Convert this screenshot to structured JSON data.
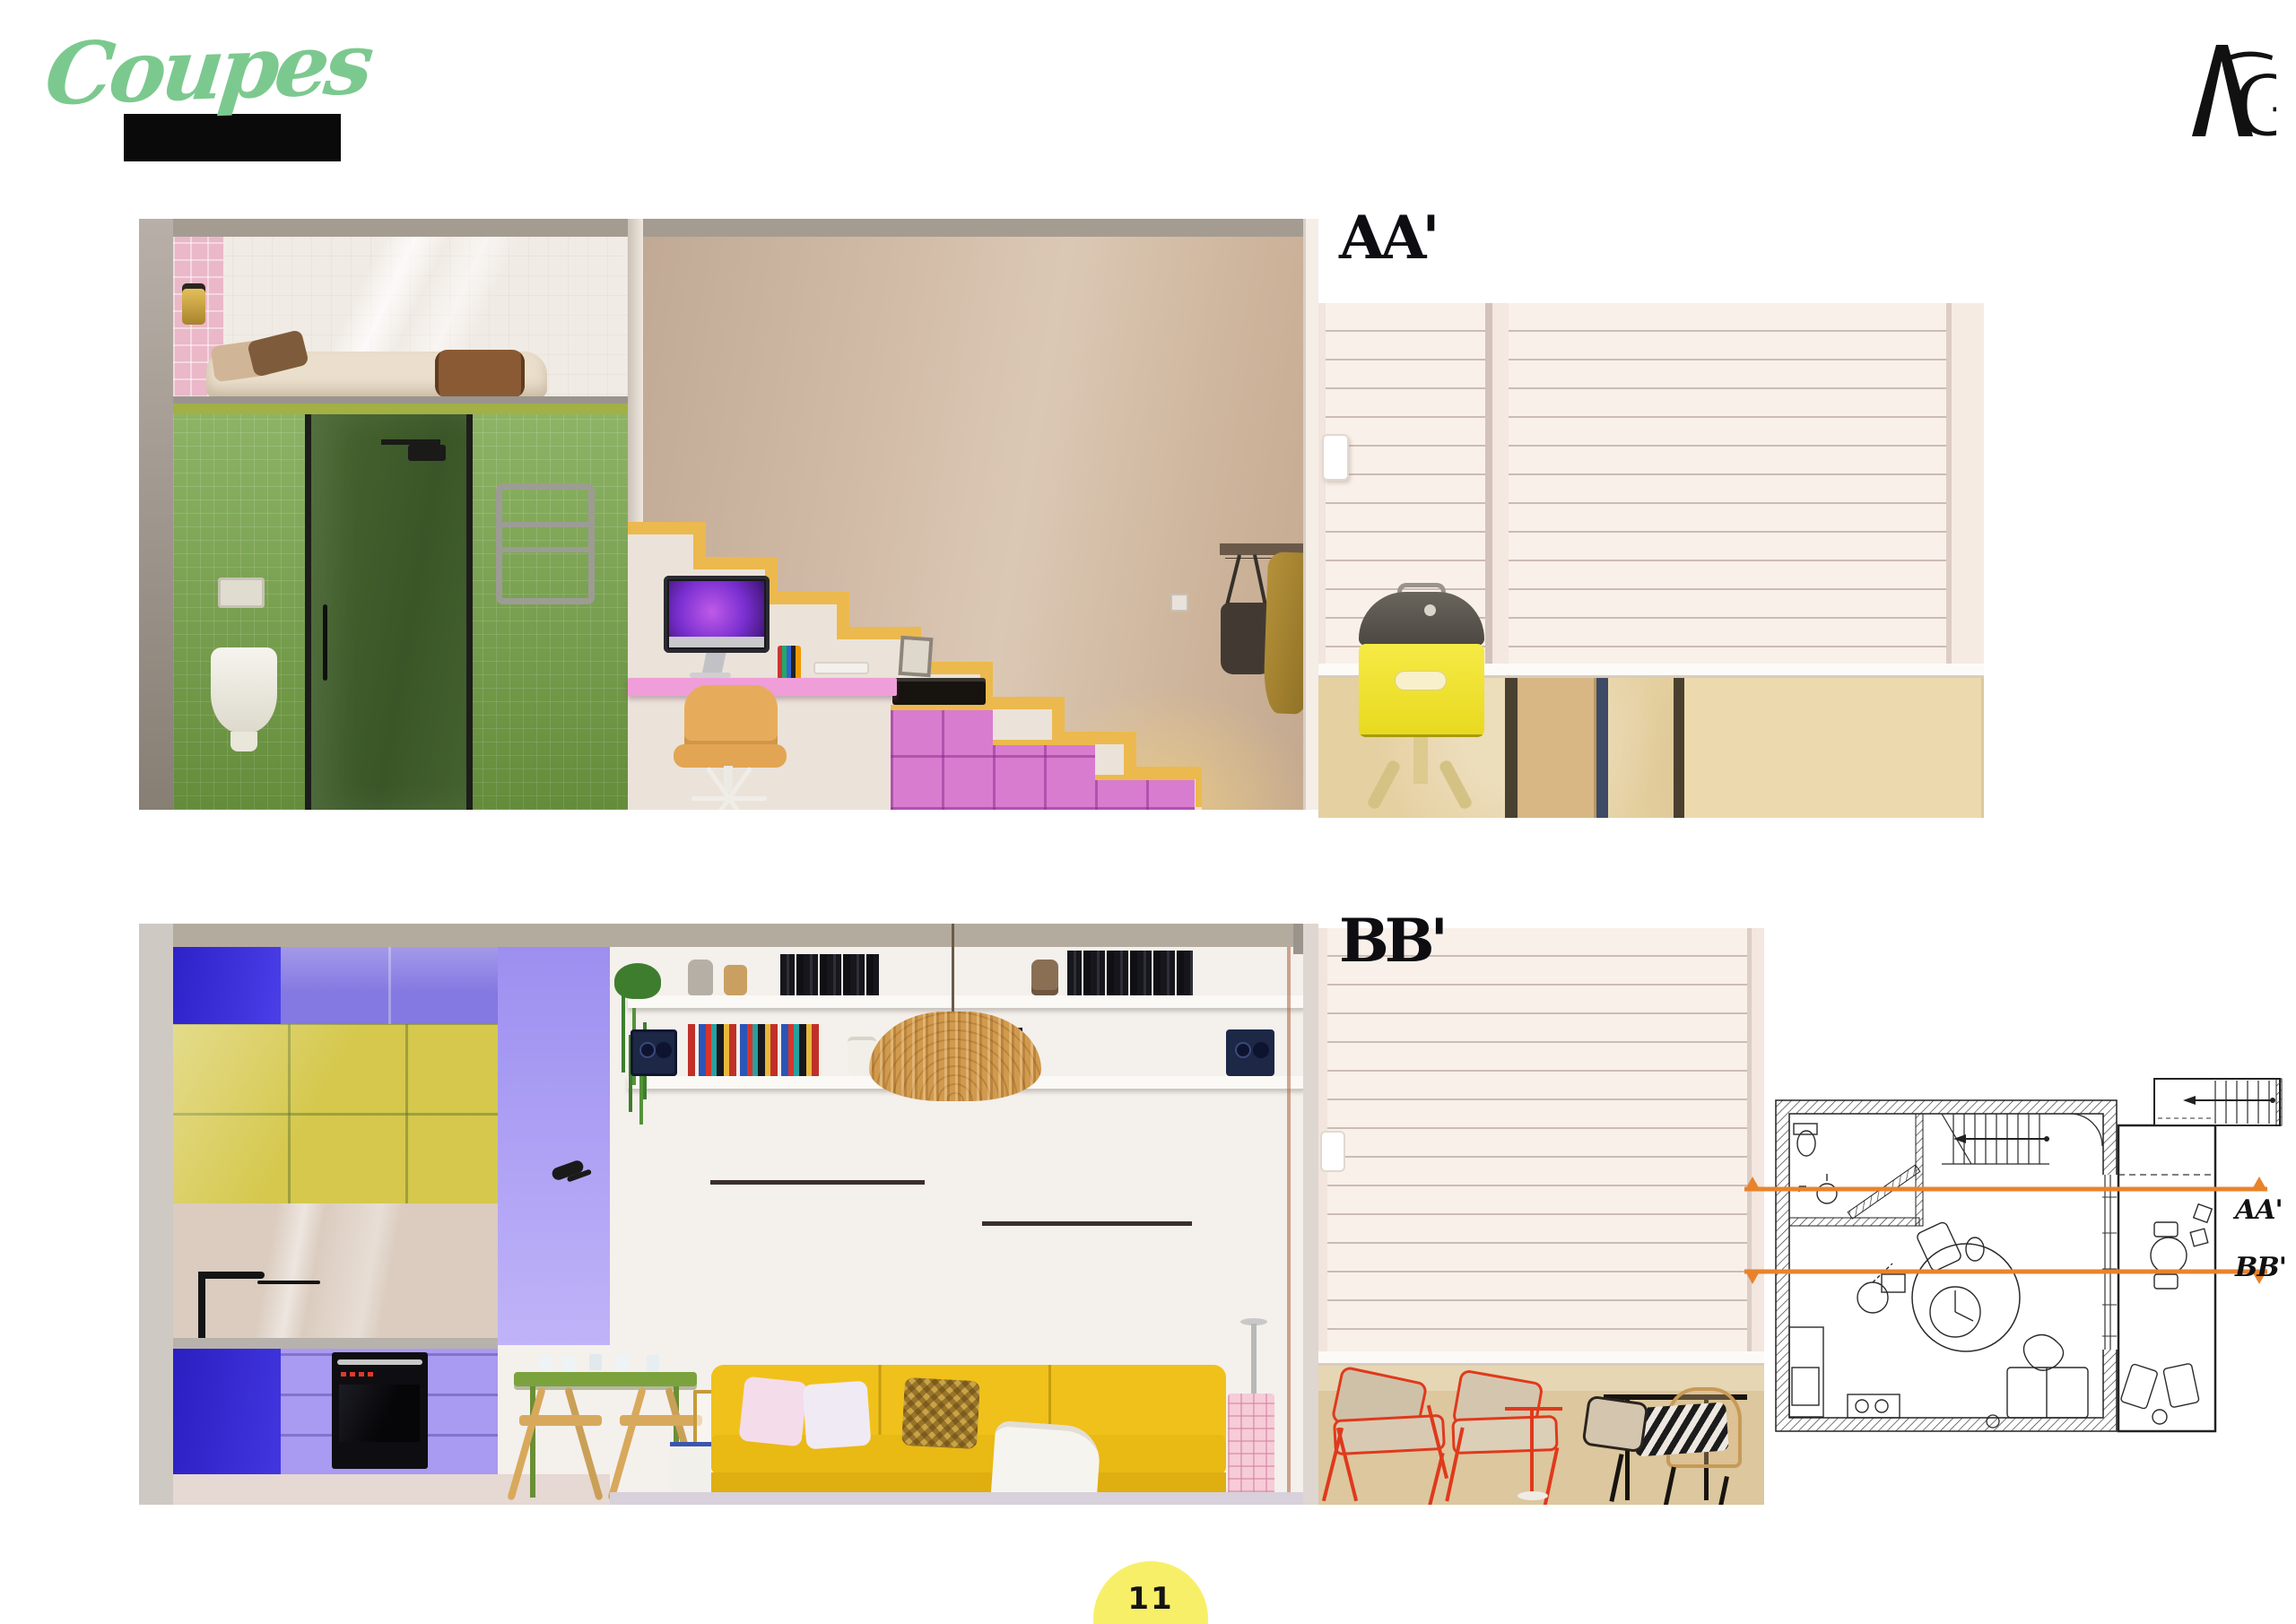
{
  "page": {
    "title": "Coupes",
    "logo_g": "G",
    "logo": "AG",
    "page_number": "11"
  },
  "sections": {
    "aa": {
      "label": "AA'"
    },
    "bb": {
      "label": "BB'"
    }
  },
  "plan": {
    "aa_label": "AA'",
    "bb_label": "BB'",
    "line_color": "#E8832C"
  },
  "colors": {
    "title_green": "#7CC98F",
    "accent_black": "#0A0A0A",
    "section_line_orange": "#E8832C",
    "page_circle_yellow": "#F8EF69",
    "stair_trim_yellow": "#ECB94E",
    "under_stair_storage_pink": "#DA7ED2",
    "bathroom_tile_green": "#74A344",
    "kitchen_cabinet_blue": "#342BD4",
    "kitchen_cabinet_lilac": "#8478E2",
    "kitchen_glass_yellow": "#D5C84D",
    "sofa_yellow": "#F0C11A",
    "bbq_yellow": "#F2E42E",
    "balcony_chair_red": "#E0391C"
  }
}
